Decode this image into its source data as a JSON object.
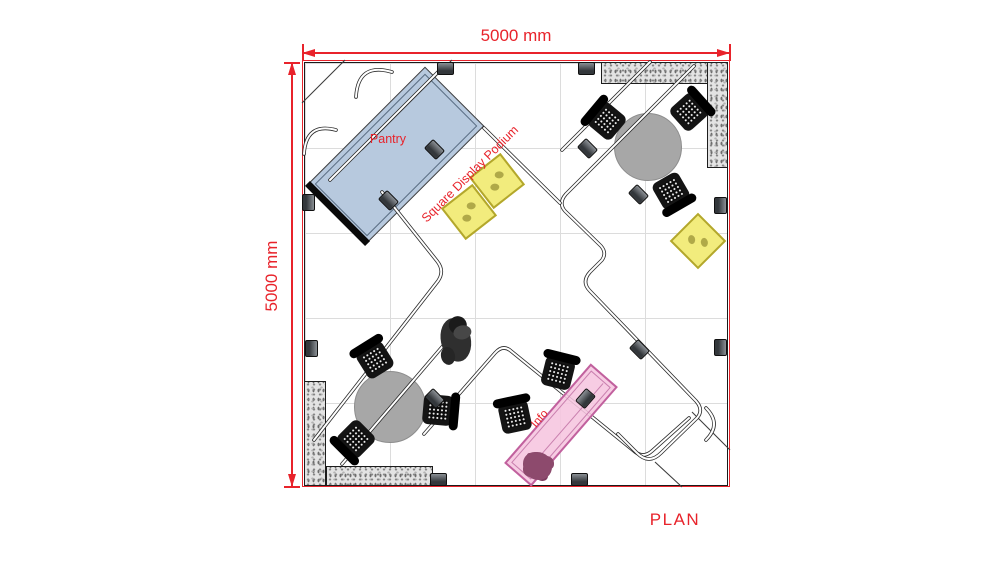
{
  "drawing": {
    "type": "exhibition-booth-floor-plan",
    "plan_label": "PLAN",
    "dimensions": {
      "top": "5000 mm",
      "left": "5000 mm"
    }
  },
  "labels": {
    "pantry": "Pantry",
    "podium": "Square Display Podium",
    "info": "Info"
  },
  "colors": {
    "annotation_red": "#e8232b",
    "pantry_fill": "#b7c9de",
    "podium_fill": "#f2ec7d",
    "podium_dot": "#a9a243",
    "info_fill": "#f6c5df",
    "info_border": "#c1619e",
    "plant": "#8d4a6d",
    "table_fill": "#a7a7a7",
    "wall_fill": "#e3e3e3",
    "grid": "#dcdcdc",
    "truss": "#2b2b2b"
  },
  "inventory": {
    "round_tables": 2,
    "chairs": 8,
    "square_display_podiums": 3,
    "info_counters": 1,
    "pantry_counters": 1,
    "people": 1
  }
}
